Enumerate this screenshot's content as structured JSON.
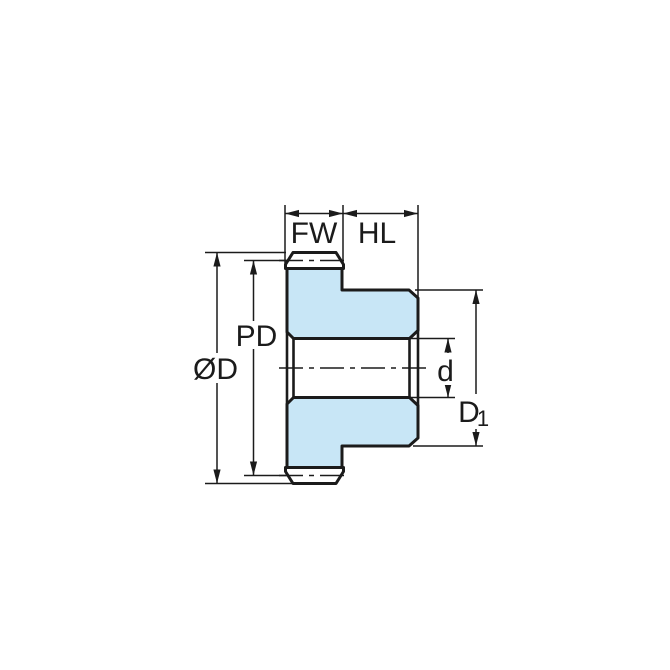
{
  "dimension_labels": {
    "face_width": "FW",
    "hub_length": "HL",
    "pitch_diameter": "PD",
    "outside_diameter": "ØD",
    "bore_diameter": "d",
    "hub_diameter_main": "D",
    "hub_diameter_sub": "1"
  },
  "colors": {
    "body_fill": "#C8E6F6",
    "line": "#1B1B1B",
    "background": "#FFFFFF"
  }
}
